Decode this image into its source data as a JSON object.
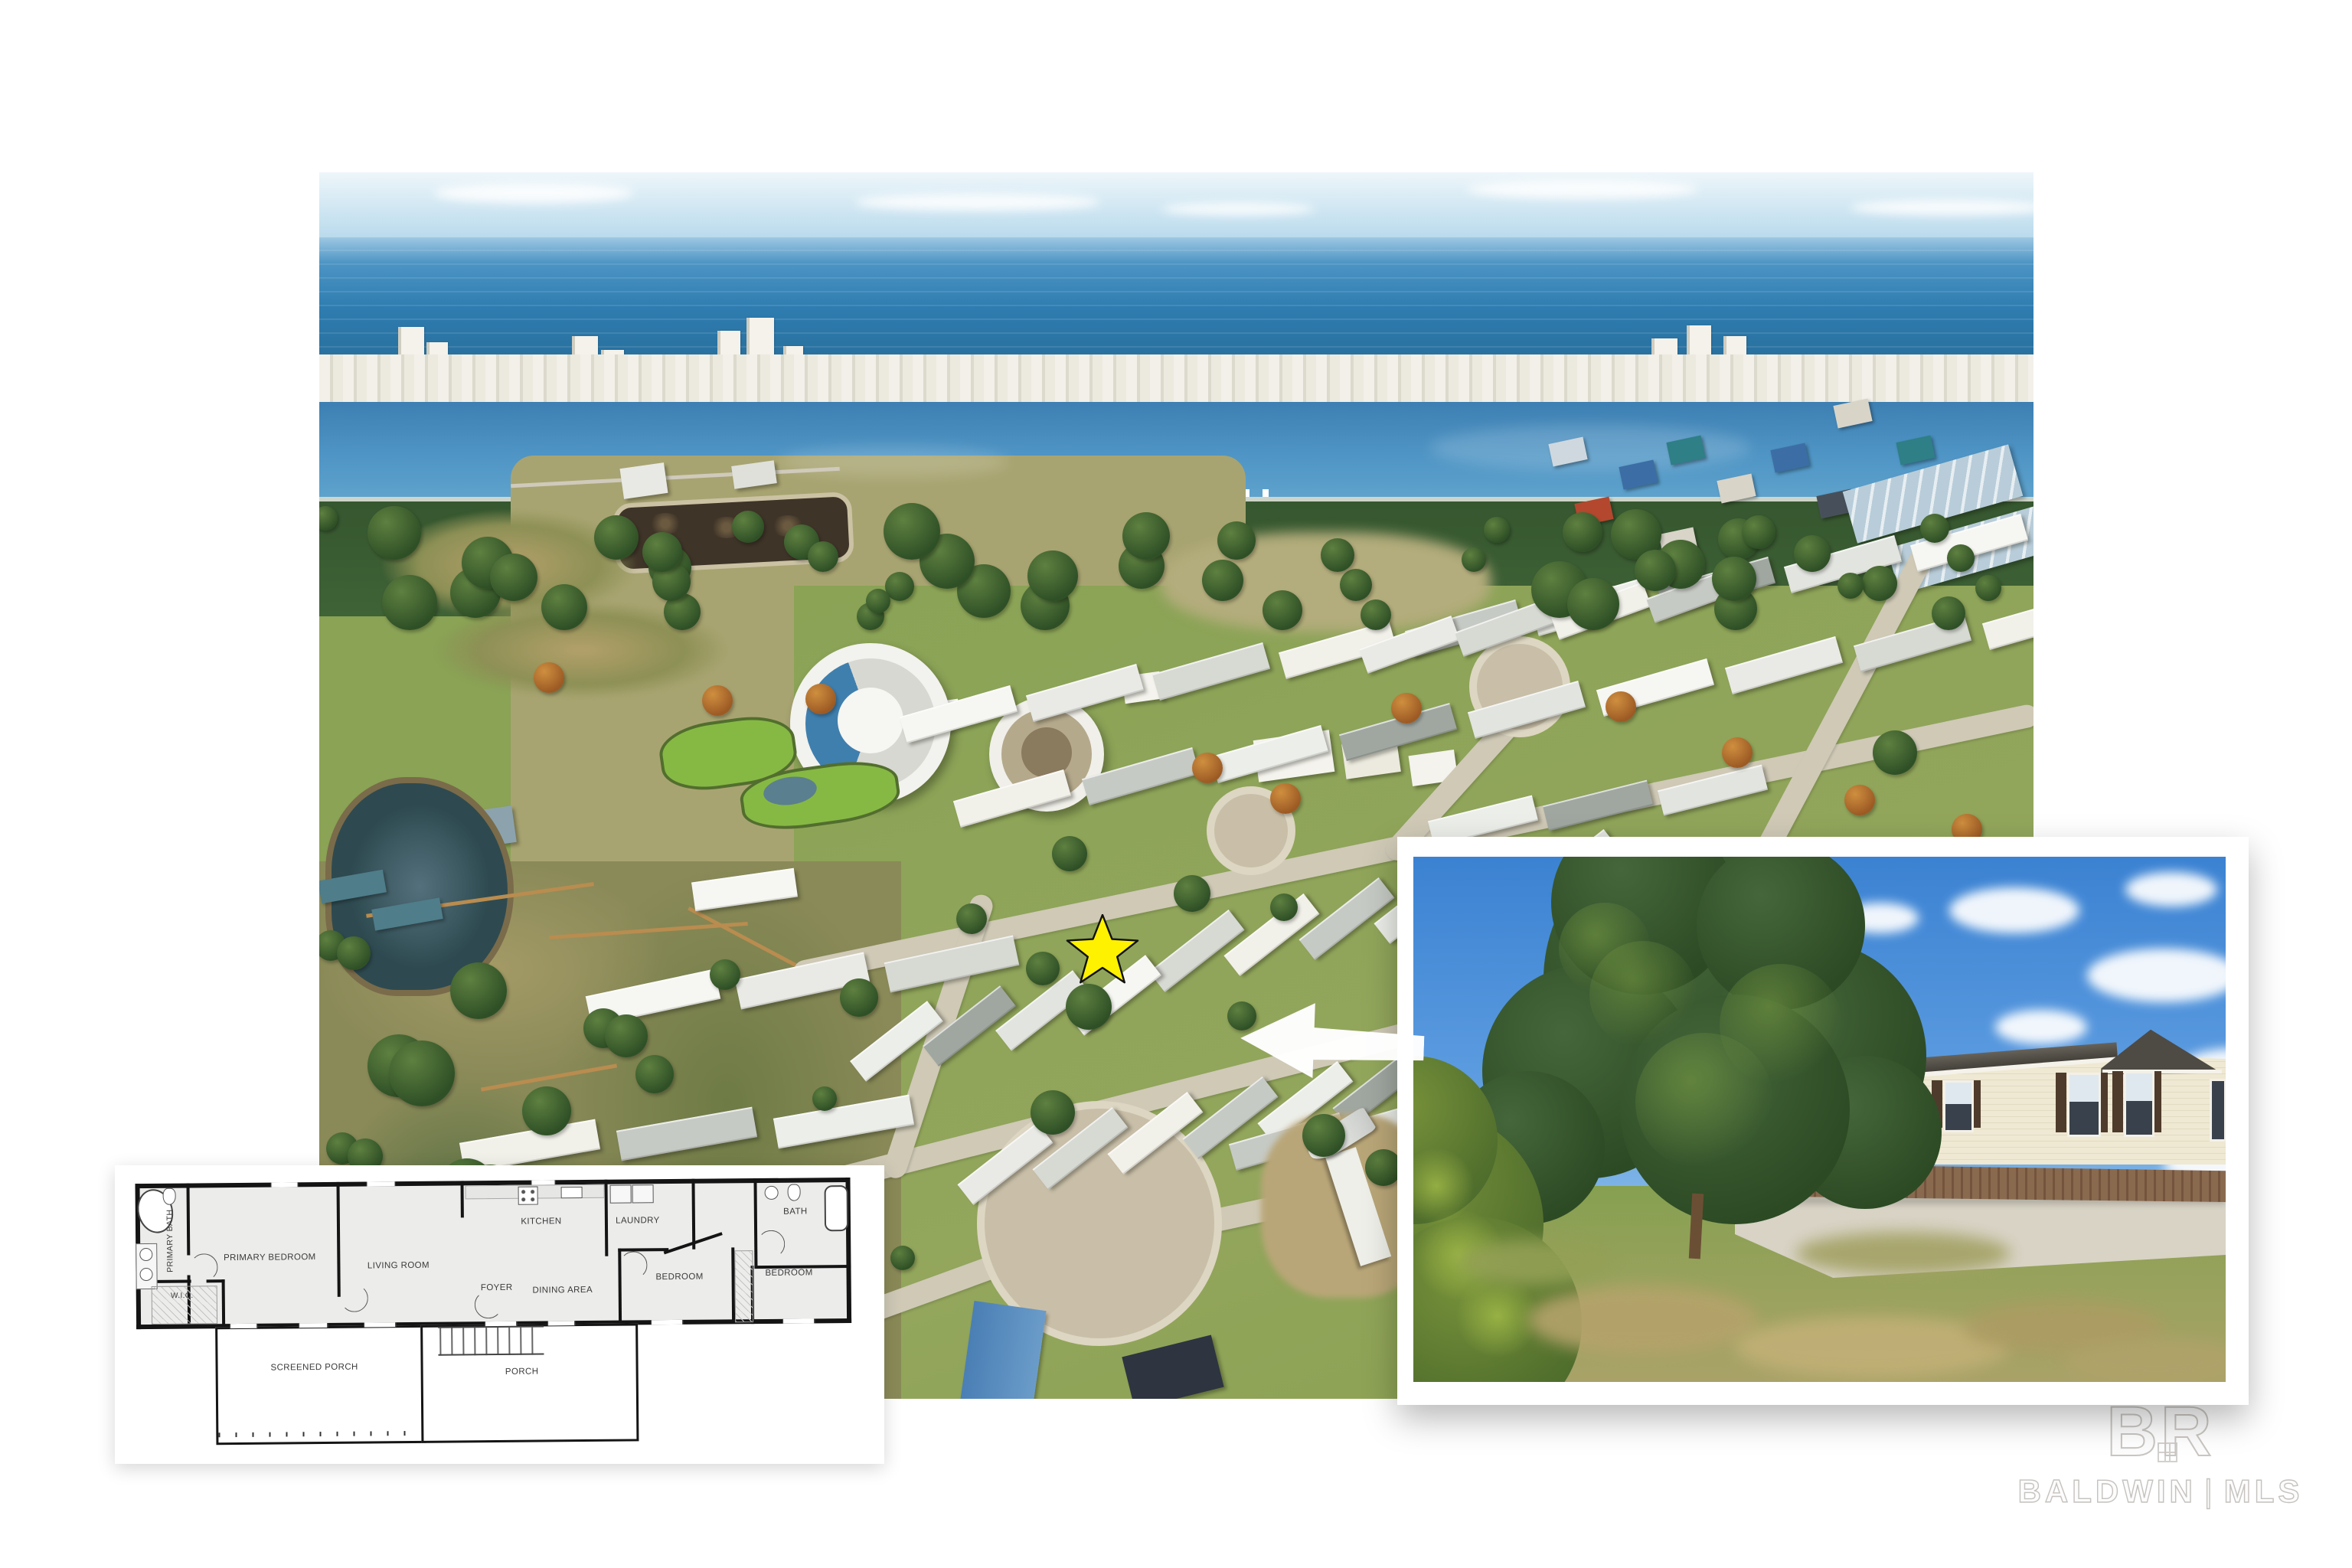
{
  "floor_plan": {
    "rooms": [
      {
        "id": "primary-bath",
        "label": "PRIMARY BATH"
      },
      {
        "id": "wic",
        "label": "W.I.C."
      },
      {
        "id": "primary-bedroom",
        "label": "PRIMARY BEDROOM"
      },
      {
        "id": "living-room",
        "label": "LIVING ROOM"
      },
      {
        "id": "kitchen",
        "label": "KITCHEN"
      },
      {
        "id": "foyer",
        "label": "FOYER"
      },
      {
        "id": "dining-area",
        "label": "DINING AREA"
      },
      {
        "id": "laundry",
        "label": "LAUNDRY"
      },
      {
        "id": "bath",
        "label": "BATH"
      },
      {
        "id": "bedroom-2",
        "label": "BEDROOM"
      },
      {
        "id": "bedroom-3",
        "label": "BEDROOM"
      },
      {
        "id": "screened-porch",
        "label": "SCREENED PORCH"
      },
      {
        "id": "porch",
        "label": "PORCH"
      }
    ]
  },
  "watermark": {
    "logo": "BR",
    "brand": "BALDWIN",
    "divider": "|",
    "suffix": "MLS"
  },
  "icons": {
    "star_marker": "star",
    "callout_arrow": "left-arrow"
  },
  "colors": {
    "star_yellow": "#FFF200",
    "star_outline": "#111111",
    "arrow_white": "#FFFFFF",
    "ocean": "#2e7cb0",
    "lagoon": "#4a8fc0",
    "sky": "#cfe6f2",
    "inset_sky": "#3b82d2",
    "grass": "#8aa355",
    "road": "#cfc9b6",
    "roof_dark": "#4e4a44",
    "siding_cream": "#efe8d2",
    "skirting_brown": "#7d5c43",
    "plan_wall": "#141414",
    "watermark_gray": "#c9c6c2"
  }
}
